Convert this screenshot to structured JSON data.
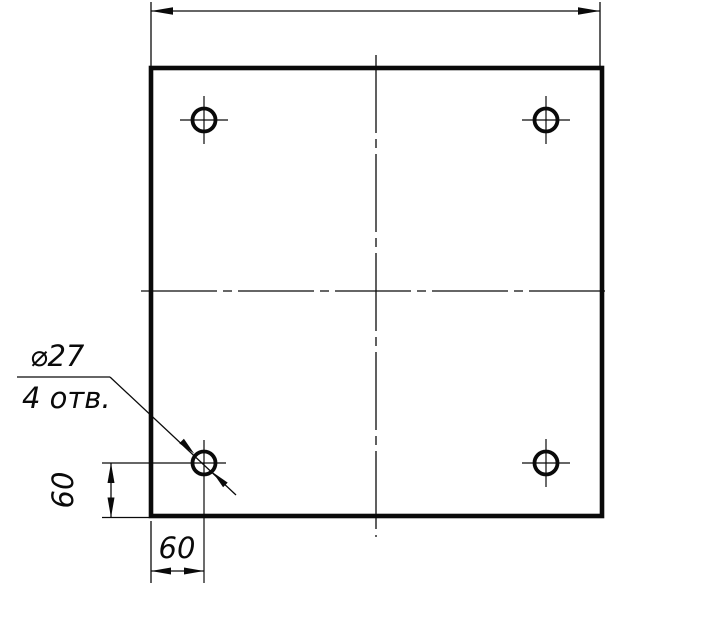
{
  "drawing": {
    "colors": {
      "background": "#ffffff",
      "line": "#0a0a0a"
    },
    "labels": {
      "callout_line1": "⌀27",
      "callout_line2": "4 отв.",
      "vertical_offset": "60",
      "horizontal_offset": "60"
    },
    "holes": {
      "count": 4,
      "positions": [
        "top-left",
        "top-right",
        "bottom-left",
        "bottom-right"
      ]
    }
  }
}
